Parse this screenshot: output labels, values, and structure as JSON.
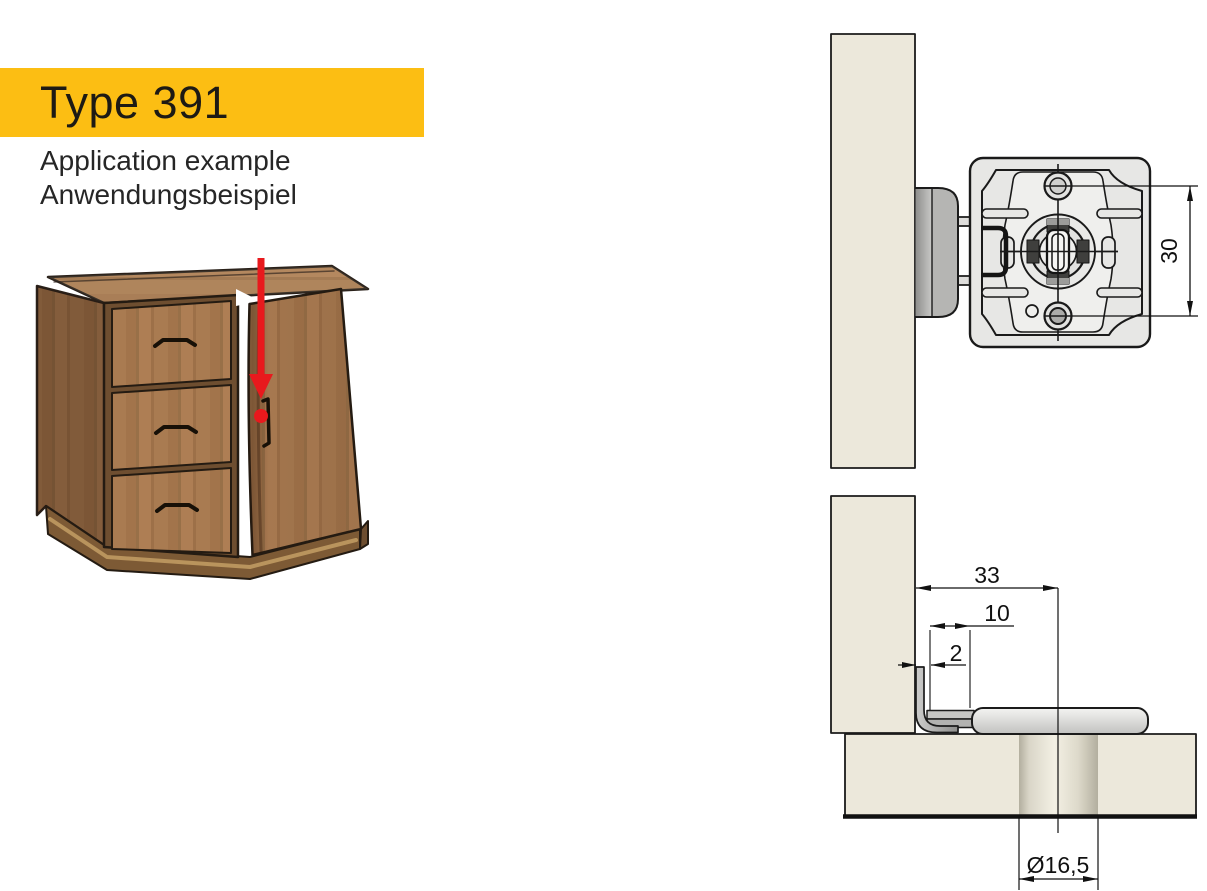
{
  "header": {
    "title": "Type 391",
    "subtitle_line1": "Application example",
    "subtitle_line2": "Anwendungsbeispiel",
    "banner_color": "#FCBE13"
  },
  "illustration": {
    "arrow_color": "#E8191D",
    "marker_color": "#E8191D",
    "wood_color": "#A87A50"
  },
  "front_view": {
    "dim_vertical": "30",
    "panel_color": "#ECE8DB",
    "metal_light": "#E7E7E5",
    "metal_mid": "#B5B5B3"
  },
  "section_view": {
    "dim_overhang": "33",
    "dim_offset": "10",
    "dim_gap": "2",
    "dim_gap_color": "#5F5690",
    "dim_hole_diameter": "Ø16,5",
    "line_color": "#1A1A1A"
  }
}
